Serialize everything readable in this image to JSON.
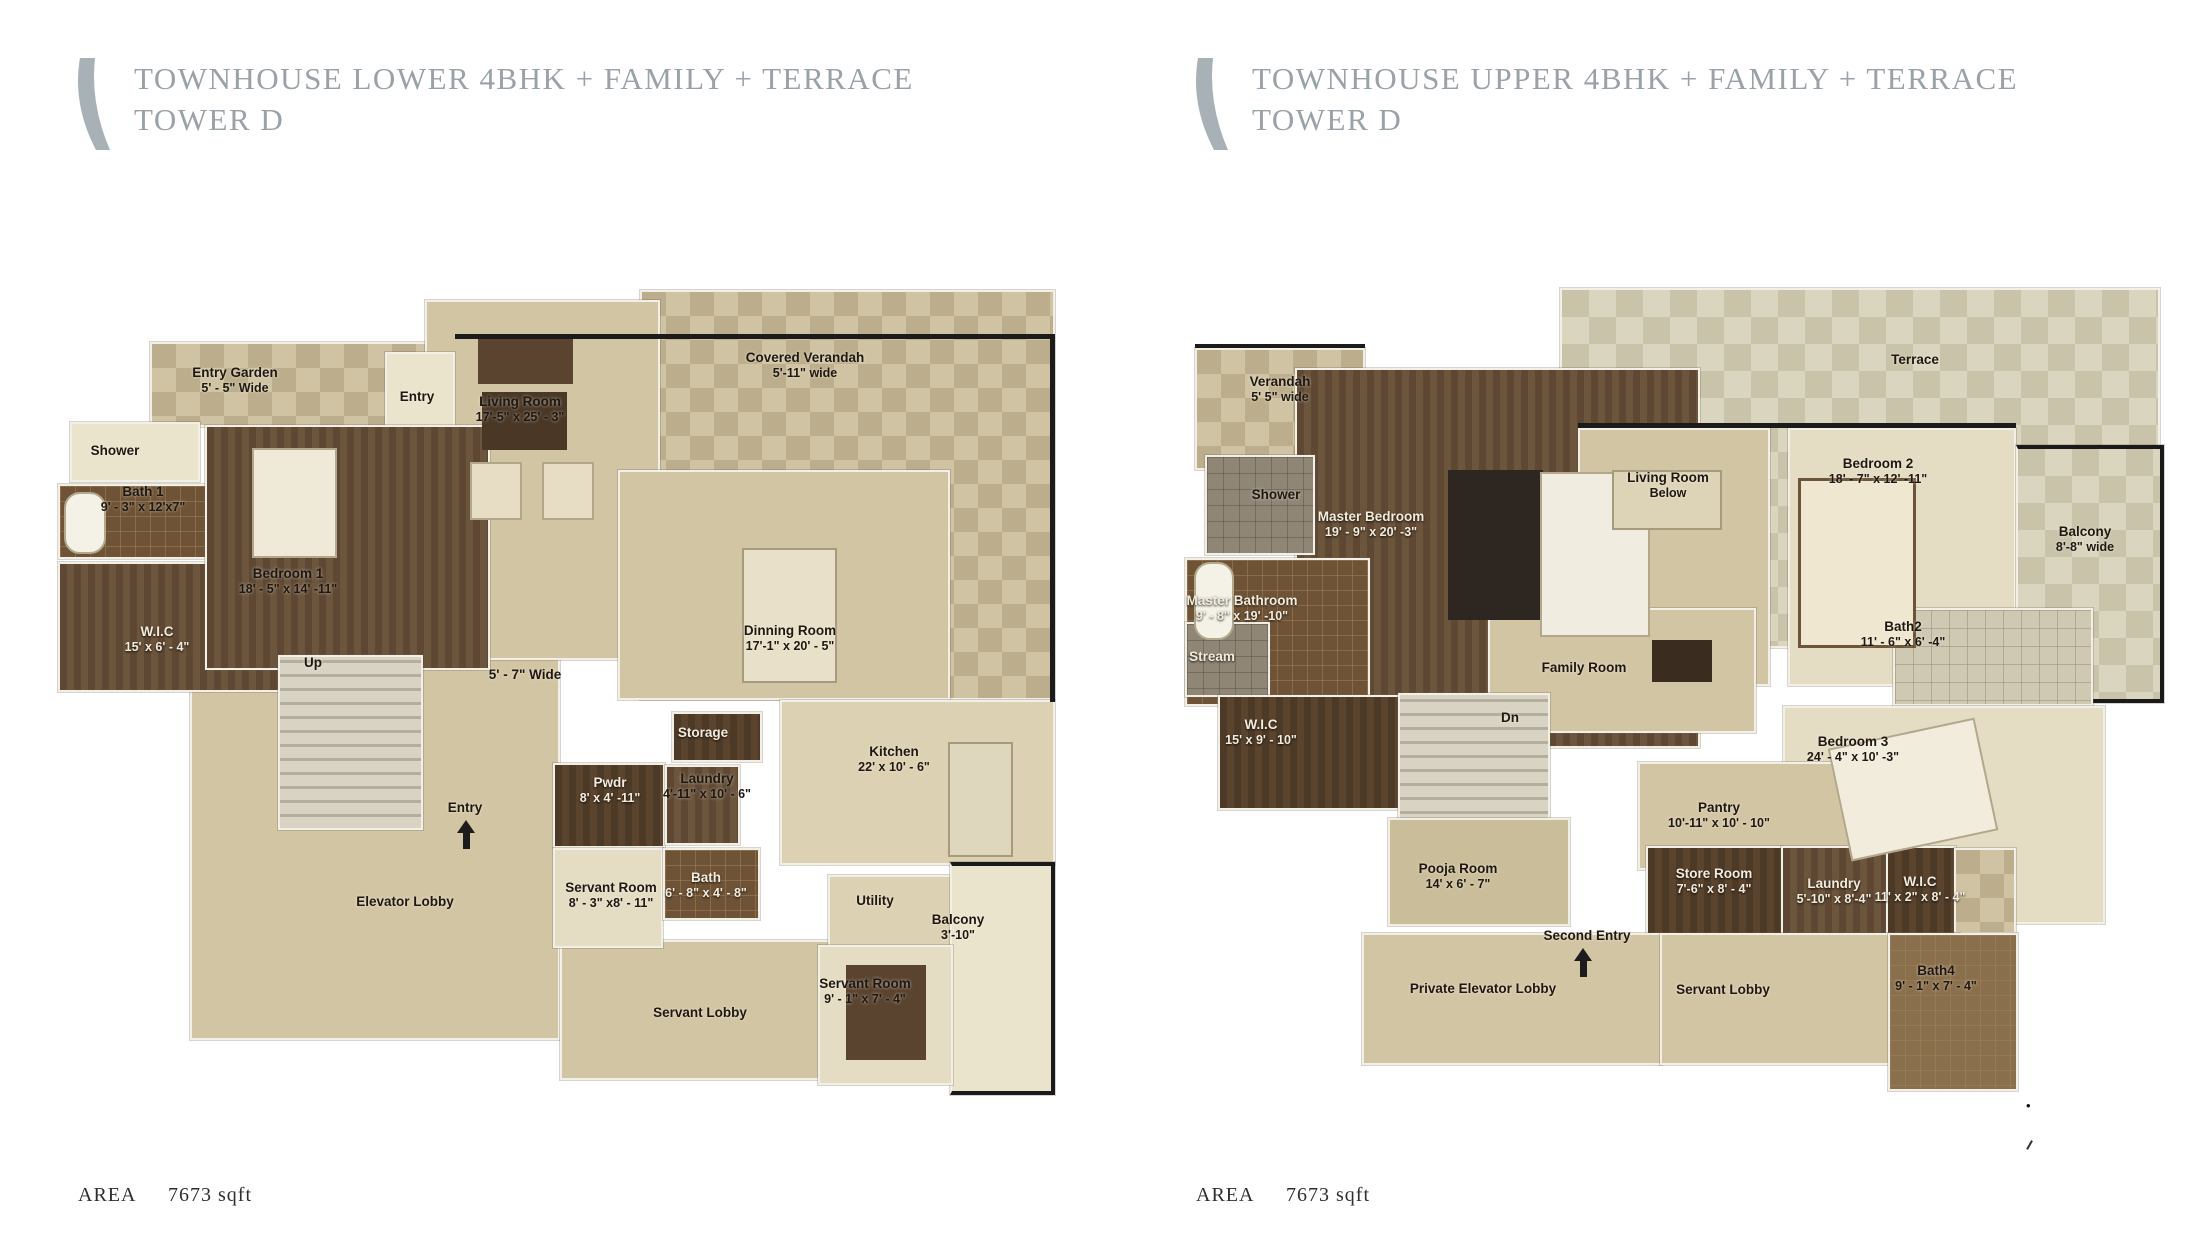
{
  "page": {
    "background": "#ffffff"
  },
  "colors": {
    "title_gray": "#98a2a7",
    "logo_gray": "#a8b1b6",
    "floor_beige": "#d2c5a4",
    "floor_wood": "#5e4833",
    "floor_tile": "#6f5336",
    "check_tan": "#bcae8c",
    "wall_white": "#f2efe6",
    "wall_dark": "#1b1b1b",
    "label_dark": "#20180e",
    "label_light": "#f3ecdd"
  },
  "plans": [
    {
      "id": "lower",
      "title_line1": "TOWNHOUSE LOWER 4BHK + FAMILY + TERRACE",
      "title_line2": "TOWER D",
      "area_label": "AREA",
      "area_value": "7673 sqft",
      "rooms": [
        {
          "name": "Entry Garden",
          "dims": "5' - 5\" Wide"
        },
        {
          "name": "Covered Verandah",
          "dims": "5'-11\" wide"
        },
        {
          "name": "Entry",
          "dims": ""
        },
        {
          "name": "Living Room",
          "dims": "17'-5\"  x 25' - 3\""
        },
        {
          "name": "Shower",
          "dims": ""
        },
        {
          "name": "Bath 1",
          "dims": "9' - 3\" x 12'x7\""
        },
        {
          "name": "Bedroom 1",
          "dims": "18' - 5\" x 14' -11\""
        },
        {
          "name": "W.I.C",
          "dims": "15' x 6' - 4\""
        },
        {
          "name": "Dinning Room",
          "dims": "17'-1\"  x 20' - 5\""
        },
        {
          "name": "Up",
          "dims": ""
        },
        {
          "name": "5' - 7\" Wide",
          "dims": ""
        },
        {
          "name": "Storage",
          "dims": ""
        },
        {
          "name": "Pwdr",
          "dims": "8' x 4' -11\""
        },
        {
          "name": "Laundry",
          "dims": "4'-11\"  x 10' - 6\""
        },
        {
          "name": "Kitchen",
          "dims": "22'  x 10' - 6\""
        },
        {
          "name": "Entry",
          "dims": ""
        },
        {
          "name": "Servant Room",
          "dims": "8' - 3\" x8' - 11\""
        },
        {
          "name": "Bath",
          "dims": "6' - 8\" x 4' - 8\""
        },
        {
          "name": "Elevator Lobby",
          "dims": ""
        },
        {
          "name": "Utility",
          "dims": ""
        },
        {
          "name": "Balcony",
          "dims": "3'-10\""
        },
        {
          "name": "Servant Lobby",
          "dims": ""
        },
        {
          "name": "Servant Room",
          "dims": "9' - 1\" x 7' - 4\""
        }
      ]
    },
    {
      "id": "upper",
      "title_line1": "TOWNHOUSE UPPER 4BHK + FAMILY + TERRACE",
      "title_line2": "TOWER D",
      "area_label": "AREA",
      "area_value": "7673 sqft",
      "rooms": [
        {
          "name": "Verandah",
          "dims": "5' 5\" wide"
        },
        {
          "name": "Terrace",
          "dims": ""
        },
        {
          "name": "Shower",
          "dims": ""
        },
        {
          "name": "Master Bedroom",
          "dims": "19' - 9\" x 20' -3\""
        },
        {
          "name": "Master Bathroom",
          "dims": "9' - 8\" x 19' -10\""
        },
        {
          "name": "Stream",
          "dims": ""
        },
        {
          "name": "W.I.C",
          "dims": "15' x 9' - 10\""
        },
        {
          "name": "Living Room",
          "dims": "Below"
        },
        {
          "name": "Bedroom 2",
          "dims": "18' - 7\" x 12' -11\""
        },
        {
          "name": "Balcony",
          "dims": "8'-8\" wide"
        },
        {
          "name": "Family Room",
          "dims": ""
        },
        {
          "name": "Dn",
          "dims": ""
        },
        {
          "name": "Bath2",
          "dims": "11' - 6\" x 6' -4\""
        },
        {
          "name": "Bedroom 3",
          "dims": "24' - 4\" x 10' -3\""
        },
        {
          "name": "Pantry",
          "dims": "10'-11\"  x 10' - 10\""
        },
        {
          "name": "Pooja Room",
          "dims": "14' x 6' - 7\""
        },
        {
          "name": "Store Room",
          "dims": "7'-6\"  x 8' - 4\""
        },
        {
          "name": "Laundry",
          "dims": "5'-10\" x 8'-4\""
        },
        {
          "name": "W.I.C",
          "dims": "11' x 2\" x 8' - 4\""
        },
        {
          "name": "Second Entry",
          "dims": ""
        },
        {
          "name": "Private Elevator Lobby",
          "dims": ""
        },
        {
          "name": "Servant Lobby",
          "dims": ""
        },
        {
          "name": "Bath4",
          "dims": "9' - 1\" x 7' - 4\""
        }
      ]
    }
  ],
  "artifacts": {
    "dot": "•"
  }
}
